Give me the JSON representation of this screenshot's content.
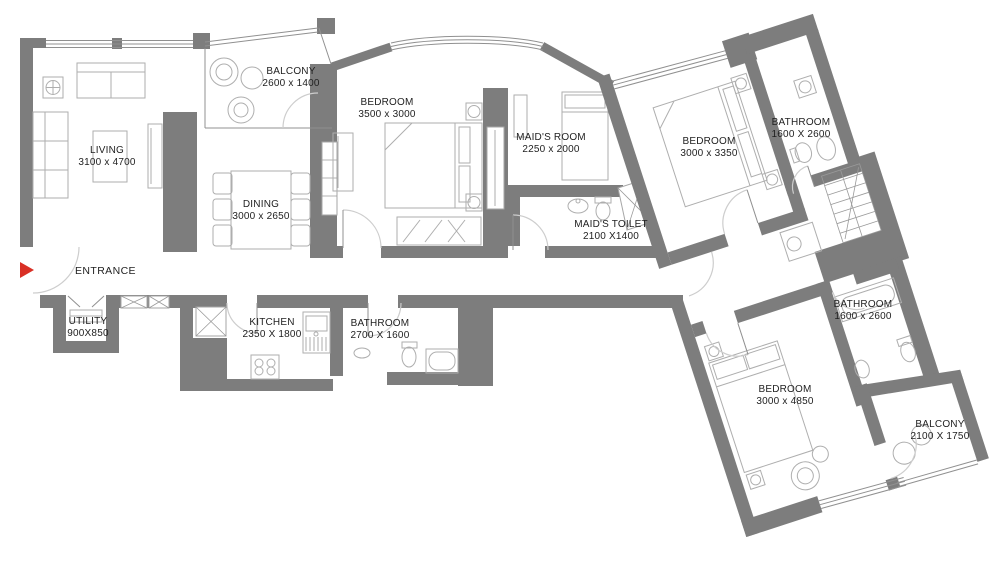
{
  "colors": {
    "wall": "#7d7d7d",
    "entrance_arrow": "#d93025",
    "label_text": "#1f1f1f",
    "background": "#ffffff"
  },
  "entrance": {
    "label": "ENTRANCE"
  },
  "rooms": [
    {
      "id": "living",
      "name": "LIVING",
      "dims": "3100 x 4700"
    },
    {
      "id": "balcony-1",
      "name": "BALCONY",
      "dims": "2600 x 1400"
    },
    {
      "id": "dining",
      "name": "DINING",
      "dims": "3000 x 2650"
    },
    {
      "id": "bedroom-1",
      "name": "BEDROOM",
      "dims": "3500 x 3000"
    },
    {
      "id": "maids-room",
      "name": "MAID'S ROOM",
      "dims": "2250 x 2000"
    },
    {
      "id": "maids-toilet",
      "name": "MAID'S TOILET",
      "dims": "2100 X1400"
    },
    {
      "id": "bedroom-2",
      "name": "BEDROOM",
      "dims": "3000 x 3350"
    },
    {
      "id": "bathroom-1",
      "name": "BATHROOM",
      "dims": "1600 X 2600"
    },
    {
      "id": "bathroom-2",
      "name": "BATHROOM",
      "dims": "1600 x 2600"
    },
    {
      "id": "bedroom-3",
      "name": "BEDROOM",
      "dims": "3000 x 4850"
    },
    {
      "id": "balcony-2",
      "name": "BALCONY",
      "dims": "2100 X 1750"
    },
    {
      "id": "kitchen",
      "name": "KITCHEN",
      "dims": "2350 X 1800"
    },
    {
      "id": "bathroom-3",
      "name": "BATHROOM",
      "dims": "2700 X 1600"
    },
    {
      "id": "utility",
      "name": "UTILITY",
      "dims": "900X850"
    }
  ]
}
